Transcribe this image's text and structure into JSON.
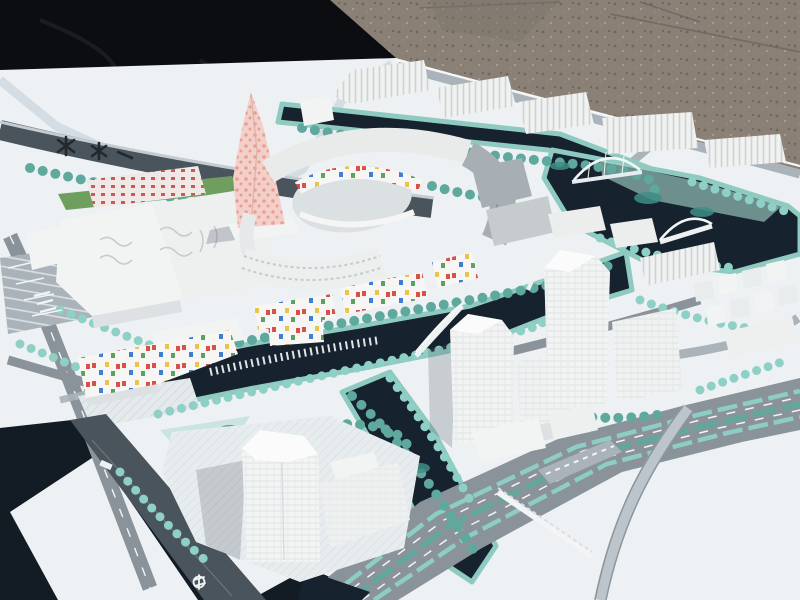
{
  "meta": {
    "alt": "Outdoor photograph of a white architectural urban-planning scale model on a baseboard, partly covered by a black tarp, sitting on gravel ground. The model shows white buildings, a pink twisted tower, an oval courtyard complex with colorful mosaic facades, dark canals with arched bridges, teal model trees, gray boulevards and a curved flyover ramp.",
    "setting": "daylight, sun from upper right, gravel lot background",
    "no_visible_text": true
  },
  "scene": {
    "elements": [
      {
        "name": "gravel-ground",
        "label": "Brown gravel ground behind the model"
      },
      {
        "name": "black-tarp",
        "label": "Black tarp draped over the upper-left corner of the board"
      },
      {
        "name": "model-baseboard",
        "label": "Large white presentation baseboard in perspective"
      },
      {
        "name": "pink-twisted-tower",
        "label": "Tall twisted landmark tower with pink dotted facade"
      },
      {
        "name": "oval-courtyard-complex",
        "label": "Ring of buildings around an oval courtyard with colorful mosaic inner walls"
      },
      {
        "name": "north-ribbed-blocks",
        "label": "Row of white ribbed slab buildings along the top edge"
      },
      {
        "name": "left-wavy-blocks",
        "label": "Large white blocks with wavy roof ribs, red-accent slab and green strip behind"
      },
      {
        "name": "confetti-housing",
        "label": "Low white housing blocks with scattered red, blue and yellow window squares"
      },
      {
        "name": "canal-network",
        "label": "Dark navy canals and basin looping through the model"
      },
      {
        "name": "arched-bridges",
        "label": "Small white arched and cable bridges over the canals"
      },
      {
        "name": "right-tower-cluster",
        "label": "Cluster of tall white gridded towers and slabs on the right island"
      },
      {
        "name": "cube-blocks",
        "label": "Field of small white cubic blocks at upper right"
      },
      {
        "name": "south-tower",
        "label": "Translucent white high-rise on a striped plaza island at bottom center"
      },
      {
        "name": "boulevard",
        "label": "Wide gray boulevard with teal planted medians crossing the lower right"
      },
      {
        "name": "flyover-ramp",
        "label": "Curved elevated ramp over the boulevard"
      },
      {
        "name": "model-trees",
        "label": "Rows and clusters of teal foam trees"
      },
      {
        "name": "board-emblem-marks",
        "label": "Small dark illegible emblem marks printed on the board, upper left"
      },
      {
        "name": "rail-symbol-marking",
        "label": "Small white transit glyph on the dark edge road, bottom left"
      }
    ]
  },
  "palette": {
    "gravel": "#8a8076",
    "gravel_dark": "#6e655c",
    "tarp": "#0c0d10",
    "board": "#edf1f3",
    "board_shadow": "#cfd9df",
    "under_dark": "#131b24",
    "road": "#8a939a",
    "road_dark": "#4a545c",
    "road_light": "#aab3b9",
    "lane": "#f2f5f6",
    "water": "#16222e",
    "shore": "#8fcac0",
    "park": "#a8d8cf",
    "tree_light": "#8ed0c6",
    "tree_mid": "#5fa89e",
    "tree_dark": "#3f8d85",
    "grass": "#6f9e5f",
    "glass": "#a7aeb4",
    "bldg_white": "#f2f4f3",
    "bldg_face": "#dde1e3",
    "pink": "#f3cfca",
    "pink_dot": "#e8998c",
    "accent_red": "#cc5a52",
    "mosaic_red": "#d85046",
    "mosaic_blue": "#3f7fd0",
    "mosaic_yellow": "#e6c44d",
    "mosaic_green": "#57a45f",
    "ramp": "#bcc5cb",
    "shadow": "#5a6470",
    "emblem": "#23282d"
  }
}
